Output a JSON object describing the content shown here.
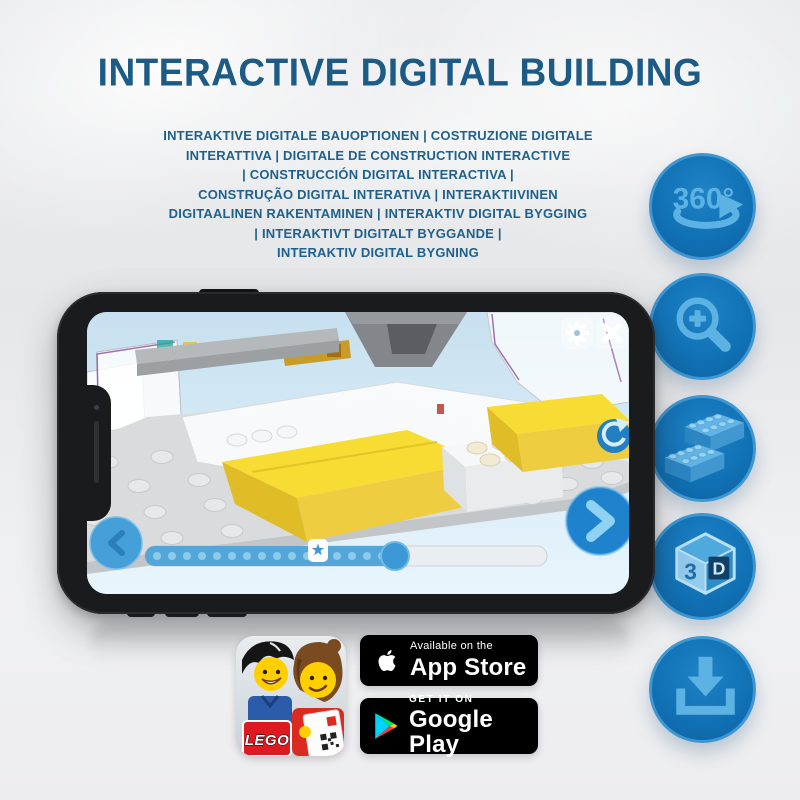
{
  "title": "INTERACTIVE DIGITAL BUILDING",
  "subtitle_lines": [
    "INTERAKTIVE DIGITALE BAUOPTIONEN | COSTRUZIONE DIGITALE",
    "INTERATTIVA | DIGITALE DE CONSTRUCTION INTERACTIVE",
    "| CONSTRUCCIÓN DIGITAL INTERACTIVA |",
    "CONSTRUÇÃO DIGITAL INTERATIVA | INTERAKTIIVINEN",
    "DIGITAALINEN RAKENTAMINEN | INTERAKTIV DIGITAL BYGGING",
    "| INTERAKTIVT DIGITALT BYGGANDE |",
    "INTERAKTIV DIGITAL BYGNING"
  ],
  "feature_rail": {
    "rotation_label": "360°",
    "cube_3": "3",
    "cube_d": "D",
    "icons": [
      "360-rotation",
      "zoom-in",
      "brick-stack",
      "3d-cube",
      "download"
    ]
  },
  "phone_app": {
    "slider": {
      "progress_percent": 62,
      "star_position_percent": 43,
      "dot_count": 16
    }
  },
  "app_icon": {
    "lego_logo": "LEGO"
  },
  "store_badges": {
    "app_store": {
      "tagline": "Available on the",
      "store_name": "App Store"
    },
    "google_play": {
      "tagline": "GET IT ON",
      "store_name": "Google Play"
    }
  },
  "colors": {
    "heading_blue": "#1d5b87",
    "accent_blue": "#1273b9",
    "glyph_blue": "#5db2e4",
    "brick_yellow": "#f6da2e",
    "badge_black": "#000000"
  }
}
